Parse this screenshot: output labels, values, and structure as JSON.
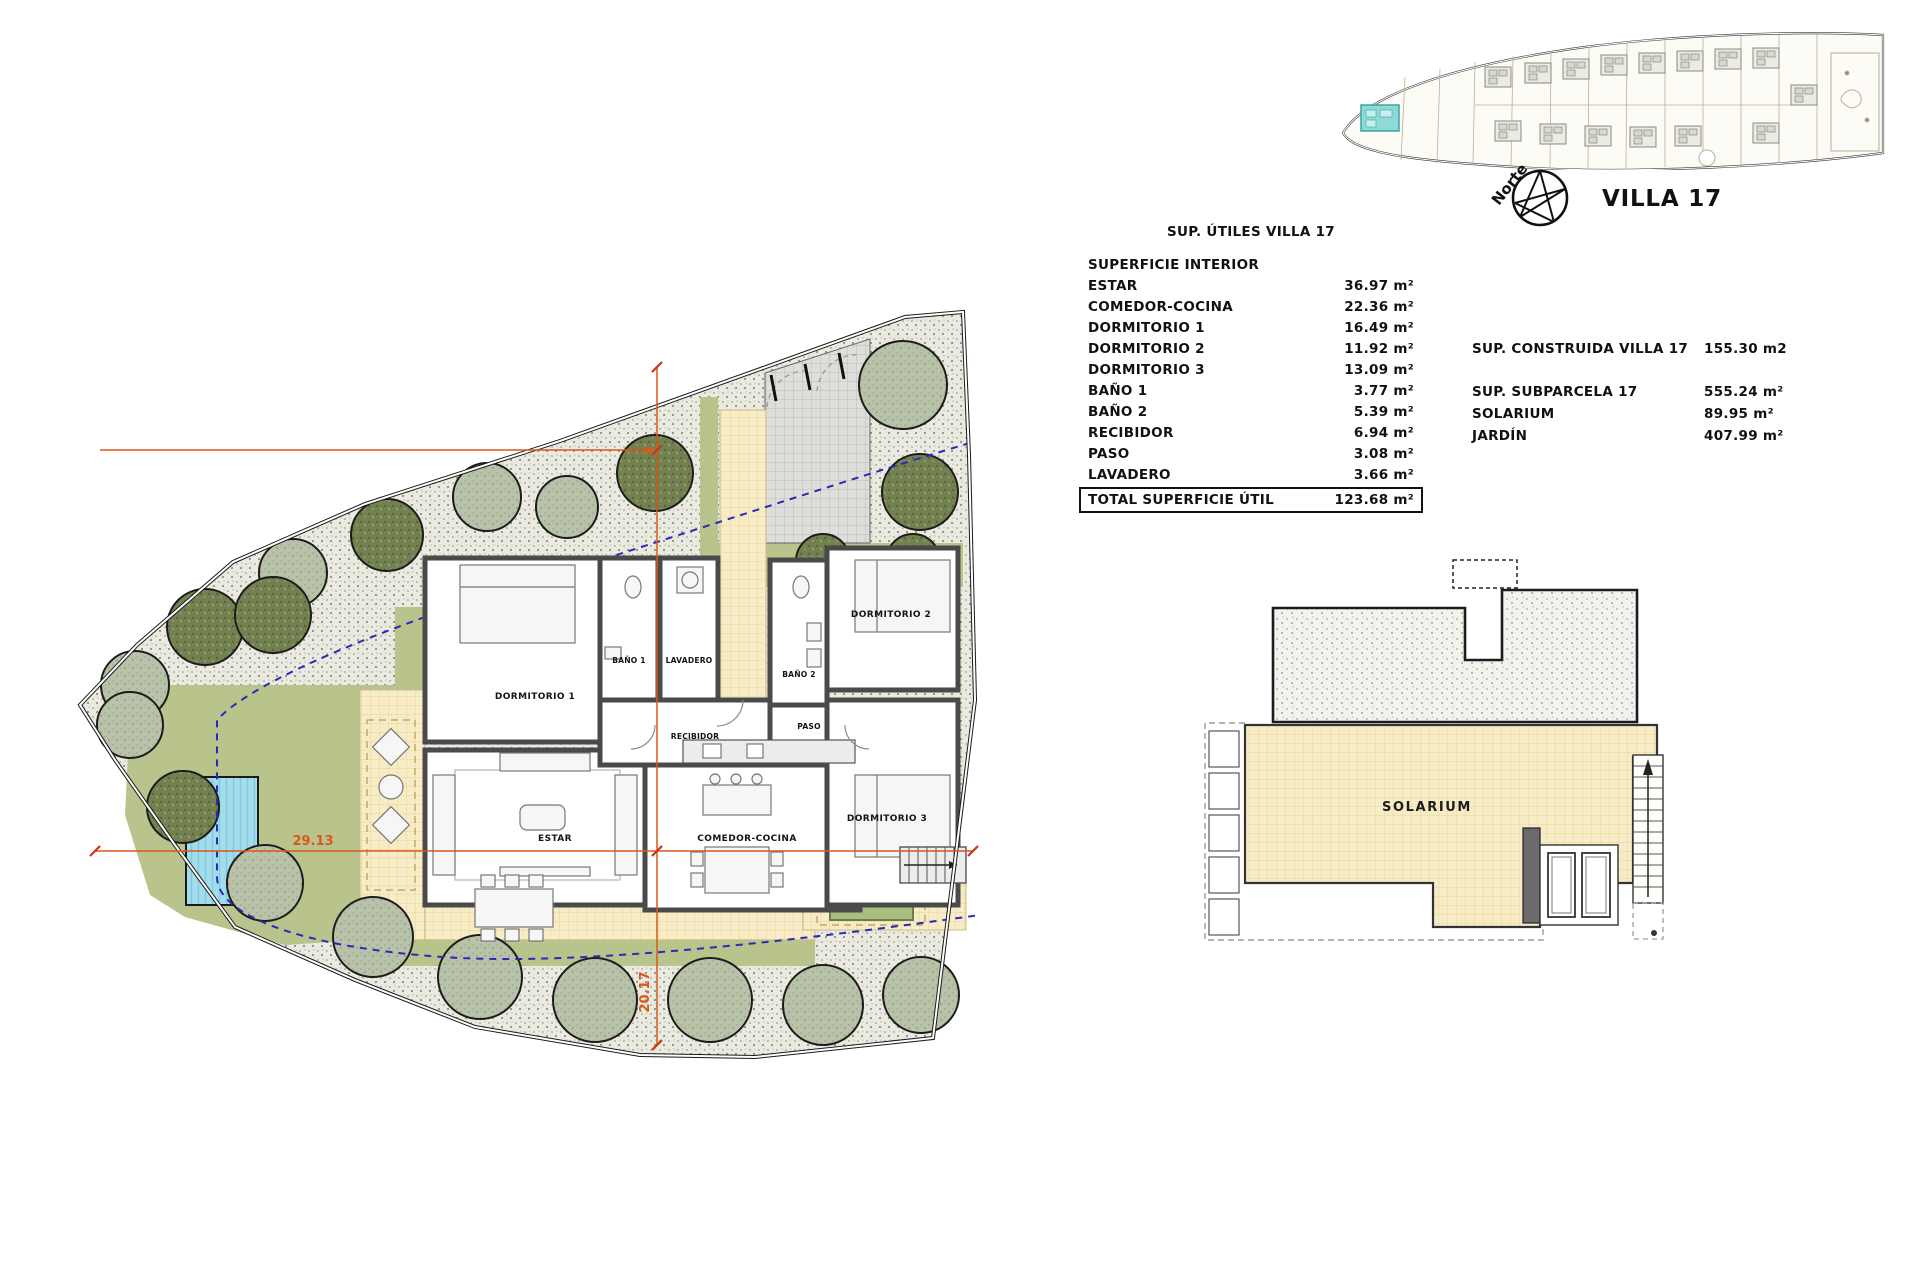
{
  "header": {
    "villa_label": "VILLA 17",
    "north_label": "Norte"
  },
  "area_table": {
    "title": "SUP. ÚTILES VILLA 17",
    "section_label": "SUPERFICIE INTERIOR",
    "rows": [
      {
        "label": "ESTAR",
        "value": "36.97 m²"
      },
      {
        "label": "COMEDOR-COCINA",
        "value": "22.36 m²"
      },
      {
        "label": "DORMITORIO 1",
        "value": "16.49 m²"
      },
      {
        "label": "DORMITORIO 2",
        "value": "11.92 m²"
      },
      {
        "label": "DORMITORIO 3",
        "value": "13.09 m²"
      },
      {
        "label": "BAÑO 1",
        "value": "3.77 m²"
      },
      {
        "label": "BAÑO 2",
        "value": "5.39 m²"
      },
      {
        "label": "RECIBIDOR",
        "value": "6.94 m²"
      },
      {
        "label": "PASO",
        "value": "3.08 m²"
      },
      {
        "label": "LAVADERO",
        "value": "3.66 m²"
      }
    ],
    "total": {
      "label": "TOTAL SUPERFICIE ÚTIL",
      "value": "123.68 m²"
    }
  },
  "summary_table": {
    "rows": [
      {
        "label": "SUP. CONSTRUIDA VILLA 17",
        "value": "155.30 m2"
      },
      {
        "label": "SUP. SUBPARCELA 17",
        "value": "555.24 m²"
      },
      {
        "label": "SOLARIUM",
        "value": "89.95 m²"
      },
      {
        "label": "JARDÍN",
        "value": "407.99 m²"
      }
    ]
  },
  "site_plan": {
    "rooms": {
      "estar": "ESTAR",
      "comedor": "COMEDOR-COCINA",
      "dorm1": "DORMITORIO 1",
      "dorm2": "DORMITORIO 2",
      "dorm3": "DORMITORIO 3",
      "bano1": "BAÑO 1",
      "bano2": "BAÑO 2",
      "recibidor": "RECIBIDOR",
      "paso": "PASO",
      "lavadero": "LAVADERO"
    },
    "dimensions": {
      "horizontal": "29.13",
      "vertical": "20.17"
    }
  },
  "solarium_plan": {
    "label": "SOLARIUM"
  },
  "colors": {
    "highlight": "#8fd9d6",
    "dimension": "#d9581c",
    "setback_line": "#2a2ab8",
    "lawn": "#b9c48c",
    "pool": "#9fd9ea",
    "terrace": "#f7ecc8"
  }
}
